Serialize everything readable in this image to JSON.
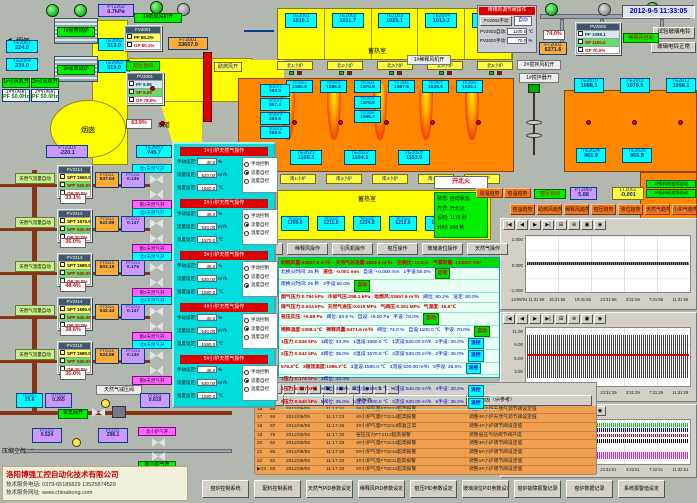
{
  "win": {
    "datetime": "2012-9-5 11:33:05"
  },
  "ui": {
    "chart_tools": [
      "|◀",
      "◀",
      "▶",
      "▶|",
      "⊞",
      "⊕",
      "▣",
      "◉"
    ],
    "alarm_tools": [
      "▤",
      "≡",
      "?",
      "▣",
      "▣",
      "▣",
      "▣",
      "⊠",
      "◉",
      "⇅",
      "✂"
    ]
  },
  "tl": {
    "flue_gas": "烟气",
    "soft_water": "软化水",
    "pt2202": {
      "tag": "PT2202",
      "value": "0.7kPa"
    },
    "boiler1": "1#余热锅炉",
    "boiler2": "2#余热锅炉",
    "te2061": {
      "tag": "TE2061",
      "value": "224.0"
    },
    "te2064": {
      "tag": "TE2064",
      "value": "239.0"
    },
    "te2062": {
      "tag": "TE2062",
      "value": "313.0"
    },
    "te2063": {
      "tag": "TE2063",
      "value": "319.0"
    },
    "fan_on": "1#助燃风机开",
    "fv2001": {
      "title": "FV2001",
      "pf": "PF  80.2%",
      "op": "OP  80.1%"
    },
    "ft2001": {
      "tag": "FT2001",
      "value": "33657.0"
    },
    "kiln_auto": "窑压自动",
    "pv2001": {
      "title": "PV2001",
      "pf": "PF  5.88",
      "sp": "SP  6.00",
      "op": "OP  78.0%"
    },
    "damper": "63.9%",
    "flue": "烟道",
    "chimney": "烟囱",
    "idfan_on1": "1#引风机开",
    "idfan_on2": "2#引风机开",
    "idfan1": {
      "tag": "1#引风机",
      "value": "PF 50.0Hz"
    },
    "idfan2": {
      "tag": "2#引风机",
      "value": "PF 50.0Hz"
    },
    "pt2003": {
      "tag": "PT2003",
      "value": "-220.1"
    },
    "te2053": {
      "tag": "TE2053",
      "value": "745.7"
    },
    "te2051": {
      "tag": "TE2051",
      "value": "585.8"
    },
    "comb_air": "助燃风开"
  },
  "regen": {
    "label": "蓄热室",
    "label_s": "蓄热室",
    "top": [
      {
        "tag": "TE2001",
        "value": "1010.1"
      },
      {
        "tag": "TE2002",
        "value": "1011.7"
      },
      {
        "tag": "TE2003",
        "value": "1025.1"
      },
      {
        "tag": "TE2004",
        "value": "1013.3"
      },
      {
        "tag": "TE2005",
        "value": "1011.7"
      }
    ],
    "ports_n": [
      "北1小炉",
      "北2小炉",
      "北3小炉",
      "北4小炉",
      "北5小炉"
    ],
    "left": [
      {
        "tag": "TE2071",
        "value": "263.0"
      },
      {
        "tag": "TE2072",
        "value": "267.4"
      },
      {
        "tag": "TE2073",
        "value": "269.6"
      },
      {
        "tag": "TE2074",
        "value": "268.6"
      }
    ],
    "crown": [
      {
        "tag": "TE2001",
        "value": "1550.8"
      },
      {
        "tag": "TE2002",
        "value": "1586.2"
      },
      {
        "tag": "TE2004",
        "value": "1570.9"
      },
      {
        "tag": "TE2008",
        "value": "1567.5"
      },
      {
        "tag": "TE2007",
        "value": "1538.5"
      },
      {
        "tag": "TE2009",
        "value": "1522.1"
      }
    ],
    "crown_sub": [
      {
        "tag": "TE2023",
        "value": "1579.8"
      },
      {
        "tag": "TE2005",
        "value": "1586.7"
      }
    ],
    "bottom": [
      {
        "tag": "TE2021",
        "value": "1108.3"
      },
      {
        "tag": "TE2022",
        "value": "1104.1"
      },
      {
        "tag": "TE2023",
        "value": "1153.9"
      }
    ],
    "ports_s": [
      "南1小炉",
      "南2小炉",
      "南3小炉",
      "南4小炉",
      "南5小炉"
    ],
    "south": [
      {
        "tag": "TE2041",
        "value": "1209.6"
      },
      {
        "tag": "TE2042",
        "value": "1211.0"
      },
      {
        "tag": "TE2043",
        "value": "1224.8"
      },
      {
        "tag": "TE2044",
        "value": "1212.6"
      },
      {
        "tag": "TE2045",
        "value": "1201.8"
      }
    ],
    "right1": [
      {
        "tag": "TE2010",
        "value": "1088.1"
      },
      {
        "tag": "TE2011",
        "value": "1079.6"
      },
      {
        "tag": "TE2012",
        "value": "1098.1"
      }
    ],
    "right2": [
      {
        "tag": "TE2024",
        "value": "965.9"
      },
      {
        "tag": "TE2025",
        "value": "965.8"
      }
    ]
  },
  "tr": {
    "panel": {
      "title": "稀释风调节阀操作",
      "btn": "PV2002手动",
      "mode": "自动",
      "l1": "PV2002自动:",
      "v1": "1100.0",
      "u1": "℃",
      "l2": "PV2002手动:",
      "v2": "70.0",
      "u2": "%"
    },
    "pct": "74.0%",
    "ft2002": {
      "tag": "FT2002",
      "value": "6371.6"
    },
    "pv2002": {
      "title": "PV2002",
      "pf": "PF  1098.1",
      "sp": "SP  1100.0",
      "op": "OP  70.0%"
    },
    "auto": "稀释风自动",
    "fan1": "1#稀释风机开",
    "stir_fan": "2#搅拌风机开",
    "stirrer": "1#搅拌器开",
    "bell1": "试验玻璃电铃",
    "bell2": "玻璃电铃正常"
  },
  "fire": {
    "btn": "开北火",
    "lines": [
      "状态: 自动状态",
      "方式: 开北火",
      "设时: 1175 秒",
      "计时: 208 秒"
    ]
  },
  "rs": {
    "small": [
      "碹温趋势",
      "窑温趋势"
    ],
    "kiln_auto": "窑压自动",
    "pt2002": {
      "tag": "PT2002",
      "value": "5.88"
    },
    "lt2001": {
      "tag": "LT2001",
      "value": "-0.001"
    },
    "feeders": [
      "1#投料机变频自动",
      "2#投料机变频自动"
    ],
    "trends": [
      "窑温趋势",
      "助燃风趋势",
      "稀释风趋势",
      "窑压趋势",
      "液位趋势",
      "天然气趋势",
      "小炉气趋势"
    ]
  },
  "gas": {
    "rows": [
      {
        "auto": "天然气流量自动",
        "pv": "PV2211",
        "spt": "SPT 1560.0",
        "spf": "SPF 520.00",
        "op": "OP  30.0%",
        "ft": "FT2211",
        "ftv": "537.04",
        "pt": "PT2211",
        "ptv": "0.136",
        "pct": "33.1%",
        "n": "北1天然气开",
        "s": "南1天然气开"
      },
      {
        "auto": "天然气流量自动",
        "pv": "PV2212",
        "spt": "SPT 1570.0",
        "spf": "SPF 530.00",
        "op": "OP  20.0%",
        "ft": "FT2212",
        "ftv": "522.89",
        "pt": "PT2212",
        "ptv": "0.147",
        "pct": "35.0%",
        "n": "北2天然气开",
        "s": "南2天然气开"
      },
      {
        "auto": "天然气温度自动",
        "pv": "PV2213",
        "spt": "SPT 1580.0",
        "spf": "SPF 530.00",
        "op": "OP  25.0%",
        "ft": "FT2213",
        "ftv": "603.19",
        "pt": "PT2213",
        "ptv": "0.178",
        "pct": "48.4%",
        "n": "北3天然气开",
        "s": "南3天然气开"
      },
      {
        "auto": "天然气流量自动",
        "pv": "PV2214",
        "spt": "SPT 1590.0",
        "spf": "SPF 540.00",
        "op": "OP  30.0%",
        "ft": "FT2214",
        "ftv": "532.44",
        "pt": "PT2214",
        "ptv": "0.147",
        "pct": "38.6%",
        "n": "北4天然气开",
        "s": "南4天然气开"
      },
      {
        "auto": "天然气流量自动",
        "pv": "PV2215",
        "spt": "SPT 1580.0",
        "spf": "SPF 530.00",
        "op": "OP  20.0%",
        "ft": "FT2215",
        "ftv": "524.58",
        "pt": "PT2215",
        "ptv": "0.140",
        "pct": "35.0%",
        "n": "北5天然气开",
        "s": "南5天然气开"
      }
    ]
  },
  "sup": {
    "reducer": "天然气减压阀",
    "te2201": {
      "tag": "TE2201",
      "value": "19.6"
    },
    "pt2202": {
      "tag": "PT2202",
      "value": "0.265"
    },
    "emergency": "紧急阀开",
    "ft2201": {
      "tag": "FT2201",
      "value": "0.619"
    },
    "pt2221": {
      "tag": "PT2221",
      "value": "0.524"
    },
    "ft2221": {
      "tag": "FT2221",
      "value": "298.1"
    },
    "n": "北小炉气开",
    "s": "南小炉气开",
    "air": "压缩空气"
  },
  "popup": {
    "labels": {
      "manual": "手动设定:",
      "flow": "流量设定:",
      "temp": "温度设定:",
      "u1": "%",
      "u2": "m³/h",
      "u3": "℃"
    },
    "secs": [
      {
        "title": "1#小炉天然气操作",
        "manual": "30.0",
        "flow": "520.00",
        "temp": "1560.0",
        "radios": [
          {
            "label": "手动控制",
            "sel": 0
          },
          {
            "label": "流量自控",
            "sel": 1
          },
          {
            "label": "温度自控",
            "sel": 0
          }
        ]
      },
      {
        "title": "2#小炉天然气操作",
        "manual": "35.0",
        "flow": "530.00",
        "temp": "1570.0",
        "radios": [
          {
            "label": "手动控制",
            "sel": 0
          },
          {
            "label": "流量自控",
            "sel": 1
          },
          {
            "label": "温度自控",
            "sel": 0
          }
        ]
      },
      {
        "title": "3#小炉天然气操作",
        "manual": "35.0",
        "flow": "530.00",
        "temp": "1580.0",
        "radios": [
          {
            "label": "手动控制",
            "sel": 0
          },
          {
            "label": "流量自控",
            "sel": 0
          },
          {
            "label": "温度自控",
            "sel": 1
          }
        ]
      },
      {
        "title": "4#小炉天然气操作",
        "manual": "30.0",
        "flow": "540.00",
        "temp": "1590.0",
        "radios": [
          {
            "label": "手动控制",
            "sel": 0
          },
          {
            "label": "流量自控",
            "sel": 1
          },
          {
            "label": "温度自控",
            "sel": 0
          }
        ]
      },
      {
        "title": "5#小炉天然气操作",
        "manual": "36.0",
        "flow": "530.00",
        "temp": "1580.0",
        "radios": [
          {
            "label": "手动控制",
            "sel": 0
          },
          {
            "label": "流量自控",
            "sel": 1
          },
          {
            "label": "温度自控",
            "sel": 0
          }
        ]
      }
    ]
  },
  "ops": [
    "助燃风操作",
    "稀释风操作",
    "引风机操作",
    "窑压操作",
    "玻璃液位操作",
    "天然气操作"
  ],
  "info": {
    "header": {
      "segs": [
        {
          "t": "助燃风量:33657.6 m³/h",
          "c": "r"
        },
        {
          "t": "天然气总流量:2693.4 m³/h",
          "c": "r"
        },
        {
          "t": "空燃比: 12.5:1",
          "c": "r"
        },
        {
          "t": "气累积量: 134057.7m³",
          "c": "r"
        }
      ]
    },
    "rows": [
      {
        "segs": [
          {
            "t": "北换火时间: 25 秒",
            "c": "b"
          },
          {
            "t": "液位: -0.001 mm",
            "c": "r"
          },
          {
            "t": "自设: +0.000 mm",
            "c": "b"
          },
          {
            "t": "1手设:50.0%",
            "c": "b"
          },
          {
            "t": "自动",
            "c": "gb"
          }
        ]
      },
      {
        "segs": [
          {
            "t": "南换火时间: 25 秒",
            "c": "b"
          },
          {
            "t": "2手设:50.0%",
            "c": "b"
          },
          {
            "t": "自动",
            "c": "gb"
          }
        ]
      },
      {
        "segs": [
          {
            "t": "烟气压力:0.794 kPa",
            "c": "r"
          },
          {
            "t": "冷却气压:298.1 kPa",
            "c": "r"
          },
          {
            "t": "助燃风:33657.6 m³/h",
            "c": "r"
          },
          {
            "t": "阀位: 80.2%",
            "c": "b"
          },
          {
            "t": "设定: 80.0%",
            "c": "b"
          }
        ]
      },
      {
        "segs": [
          {
            "t": "煤气压力:0.524 kPa",
            "c": "r"
          },
          {
            "t": "天然气进压:0.619 MPa",
            "c": "r"
          },
          {
            "t": "气阀压:0.261 MPa",
            "c": "r"
          },
          {
            "t": "气温度: 19.6℃",
            "c": "r"
          }
        ]
      },
      {
        "segs": [
          {
            "t": "窑压实压: +5.88 Pa",
            "c": "r"
          },
          {
            "t": "阀位: 63.9 %",
            "c": "b"
          },
          {
            "t": "自设: +6.00 Pa",
            "c": "b"
          },
          {
            "t": "手设: 78.0%",
            "c": "b"
          },
          {
            "t": "自动",
            "c": "gb"
          }
        ]
      },
      {
        "segs": [
          {
            "t": "稀释温度:1098.1℃",
            "c": "r"
          },
          {
            "t": "稀释风量:6371.6 m³/h",
            "c": "r"
          },
          {
            "t": "阀位: 74.0 %",
            "c": "b"
          },
          {
            "t": "自设:1100.0 ℃",
            "c": "b"
          },
          {
            "t": "手设: 70.0%",
            "c": "b"
          },
          {
            "t": "自动",
            "c": "gb"
          }
        ]
      },
      {
        "segs": [
          {
            "t": "1压力:0.536 kPa",
            "c": "r"
          },
          {
            "t": "1阀位: 33.3%",
            "c": "b"
          },
          {
            "t": "1温设:1560.0 ℃",
            "c": "b"
          },
          {
            "t": "1流设:520.00 m³/h",
            "c": "b"
          },
          {
            "t": "1手设: 30.0%",
            "c": "b"
          },
          {
            "t": "流控",
            "c": "cb"
          }
        ]
      },
      {
        "segs": [
          {
            "t": "2压力:0.542 kPa",
            "c": "r"
          },
          {
            "t": "2阀位: 35.0%",
            "c": "b"
          },
          {
            "t": "2温设:1570.0 ℃",
            "c": "b"
          },
          {
            "t": "2流设:530.00 m³/h",
            "c": "b"
          },
          {
            "t": "2手设: 35.0%",
            "c": "b"
          },
          {
            "t": "流控",
            "c": "cb"
          }
        ]
      },
      {
        "segs": [
          {
            "t": "578.8℃",
            "c": "r"
          },
          {
            "t": "3碹顶温度:1586.7℃",
            "c": "r"
          },
          {
            "t": "3温设:1580.0 ℃",
            "c": "b"
          },
          {
            "t": "3流设:530.00 m³/h",
            "c": "b"
          },
          {
            "t": "3手设: 35.0%",
            "c": "b"
          },
          {
            "t": "温控",
            "c": "cb"
          }
        ]
      },
      {
        "segs": [
          {
            "t": "3压力:0.178 kPa",
            "c": "r"
          },
          {
            "t": "3阀位: 48.4%",
            "c": "b"
          }
        ]
      },
      {
        "segs": [
          {
            "t": "4压力:0.547 kPa",
            "c": "r"
          },
          {
            "t": "4阀位: 36.6%",
            "c": "b"
          },
          {
            "t": "4温设:1590.0 ℃",
            "c": "b"
          },
          {
            "t": "4流设:540.00 m³/h",
            "c": "b"
          },
          {
            "t": "4手设: 30.0%",
            "c": "b"
          },
          {
            "t": "流控",
            "c": "cb"
          }
        ]
      },
      {
        "segs": [
          {
            "t": "5压力:0.540 kPa",
            "c": "r"
          },
          {
            "t": "5阀位: 35.0%",
            "c": "b"
          },
          {
            "t": "5温设:1580.0 ℃",
            "c": "b"
          },
          {
            "t": "5流设:530.00 m³/h",
            "c": "b"
          },
          {
            "t": "5手设: 35.0%",
            "c": "b"
          },
          {
            "t": "流控",
            "c": "cb"
          }
        ]
      }
    ]
  },
  "alarm": {
    "h_fault": "故障点",
    "h_cause": "故障原因（供参考）",
    "rows": [
      {
        "no": "16",
        "code": "98",
        "date": "2012/09/05",
        "time": "11:17:21",
        "fault": "3#小炉气量FT2213超高报警",
        "cause": "调整3#小炉天然气调节阀设定值"
      },
      {
        "no": "17",
        "code": "84",
        "date": "2012/09/05",
        "time": "11:17:23",
        "fault": "4#小炉气量FT2214超高报警",
        "cause": "调整4#小炉天然气调节阀设定值"
      },
      {
        "no": "18",
        "code": "97",
        "date": "2012/09/05",
        "time": "11:17:25",
        "fault": "4#小炉气量FT2214恢复正常",
        "cause": "调整4#小炉调节阀设定值"
      },
      {
        "no": "19",
        "code": "75",
        "date": "2012/09/05",
        "time": "11:17:30",
        "fault": "窑压压力PT2112超高报警",
        "cause": "调整窑压气动调节阀开度"
      },
      {
        "no": "20",
        "code": "82",
        "date": "2012/09/05",
        "time": "11:17:33",
        "fault": "3#小炉气量FT2213超高报警",
        "cause": "调整3#小炉调节阀设定值"
      },
      {
        "no": "21",
        "code": "85",
        "date": "2012/09/05",
        "time": "11:17:33",
        "fault": "5#小炉气量FT2215超高报警",
        "cause": "调整5#小炉调节阀设定值"
      },
      {
        "no": "22",
        "code": "81",
        "date": "2012/09/05",
        "time": "11:17:33",
        "fault": "1#小炉气量FT2211超高报警",
        "cause": "调整1#小炉调节阀设定值"
      },
      {
        "no": "23",
        "code": "83",
        "date": "2012/09/05",
        "time": "11:17:33",
        "fault": "2#小炉气量FT2212超高报警",
        "cause": "调整2#小炉调节阀设定值",
        "mk": "▶"
      }
    ]
  },
  "chart_data": [
    {
      "type": "line",
      "title": "液位趋势",
      "ylabels": [
        "1.000",
        "0.000",
        "-1.000"
      ],
      "x0": "12/09/04  11:31:56",
      "xticks": [
        "15:31:56",
        "19:31:56",
        "23:31:56",
        "3:31:56",
        "7:31:56",
        "11:31:56"
      ],
      "ylim": [
        -1.0,
        1.0
      ],
      "series": [
        {
          "name": "液位",
          "color": "#000000",
          "approx_value": 0.0
        }
      ]
    },
    {
      "type": "line",
      "title": "窑压趋势",
      "ylabels": [
        "11.00",
        "9.00",
        "6.00",
        "3.00",
        "0.00"
      ],
      "x0": "12/09/04  11:31:29",
      "xticks": [
        "15:31:29",
        "19:31:29",
        "23:31:29",
        "3:31:29",
        "7:31:29",
        "11:31:29"
      ],
      "ylim": [
        0,
        11
      ],
      "series": [
        {
          "name": "窑压",
          "color": "#000000",
          "approx_value": 6.0
        },
        {
          "name": "设定",
          "color": "#ff0000",
          "approx_value": 6.0
        }
      ]
    },
    {
      "type": "line",
      "title": "小炉温度趋势",
      "ylabels": [
        "1592.0",
        "1578.0",
        "1561.0",
        "1544.0",
        "1527.0"
      ],
      "x0": "12/09/04  11:32:51",
      "xticks": [
        "15:32:51",
        "19:32:51",
        "23:32:51",
        "3:32:51",
        "7:32:51",
        "11:32:51"
      ],
      "ylim": [
        1527,
        1592
      ],
      "series": [
        {
          "name": "1#小炉",
          "color": "#00cc00",
          "approx_value": 1586
        },
        {
          "name": "2#小炉",
          "color": "#0000ff",
          "approx_value": 1578
        },
        {
          "name": "3#小炉",
          "color": "#ff0000",
          "approx_value": 1570
        },
        {
          "name": "4#小炉",
          "color": "#000000",
          "approx_value": 1562
        },
        {
          "name": "5#小炉",
          "color": "#ff00ff",
          "approx_value": 1537
        }
      ]
    }
  ],
  "footer": {
    "buttons": [
      "窑炉控制系统",
      "配料控制系统",
      "天然气PID参数设定",
      "稀释风PID参数设定",
      "窑压PID参数设定",
      "玻璃液位PID参数设定",
      "窑炉故障报警记录",
      "窑炉数据记录",
      "系统报警值设定"
    ]
  },
  "co": {
    "name": "洛阳博强工控自动化技术有限公司",
    "phone": "技术服务电话: 0379-65185829  13525874529",
    "web": "技术服务网址: www.chinabong.com"
  }
}
